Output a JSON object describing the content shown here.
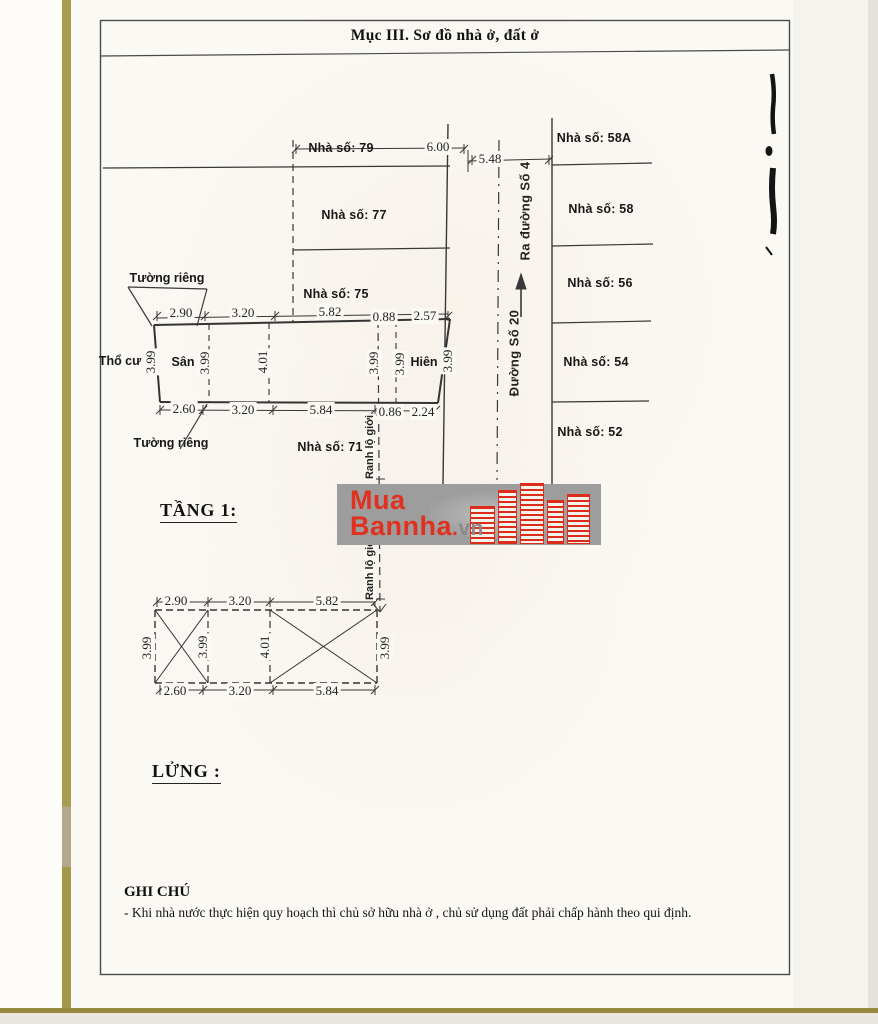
{
  "document": {
    "section_title": "Mục III. Sơ đồ nhà ở, đất ở",
    "note": {
      "heading": "GHI CHÚ",
      "body": "- Khi nhà nước thực hiện quy hoạch thì chủ sở hữu nhà ở , chủ sử dụng đất phải chấp hành theo qui định."
    }
  },
  "diagram": {
    "floor_labels": {
      "floor1": "TẦNG 1:",
      "mezzanine": "LỬNG :"
    },
    "streets": {
      "to_street": "Ra đường Số 4",
      "main_street": "Đường Số 20"
    },
    "boundary_label": "Ranh lộ giới",
    "left_houses": [
      "Nhà số: 79",
      "Nhà số: 77",
      "Nhà số: 75",
      "Nhà số: 71"
    ],
    "right_houses": [
      "Nhà số: 58A",
      "Nhà số: 58",
      "Nhà số: 56",
      "Nhà số: 54",
      "Nhà số: 52"
    ],
    "area_labels": {
      "private_wall_top": "Tường riêng",
      "private_wall_bottom": "Tường riêng",
      "residential_land": "Thổ cư",
      "yard": "Sân",
      "porch": "Hiên"
    },
    "road_dims": {
      "d1": "6.00",
      "d2": "5.48"
    },
    "plot": {
      "top_dims": [
        "2.90",
        "3.20",
        "5.82",
        "0.88",
        "2.57"
      ],
      "bottom_dims": [
        "2.60",
        "3.20",
        "5.84",
        "0.86",
        "2.24"
      ],
      "vertical_dims": [
        "3.99",
        "3.99",
        "4.01",
        "3.99",
        "3.99",
        "3.99"
      ]
    },
    "mezzanine_plan": {
      "top_dims": [
        "2.90",
        "3.20",
        "5.82"
      ],
      "bottom_dims": [
        "2.60",
        "3.20",
        "5.84"
      ],
      "vertical_dims": [
        "3.99",
        "3.99",
        "4.01",
        "3.99"
      ]
    }
  },
  "watermark": {
    "brand_line1": "Mua",
    "brand_line2": "Bannha",
    "domain_dot": ".",
    "domain_suffix": "vn",
    "accent_red": "#e0301e",
    "band_gray": "#9d9d9d"
  }
}
